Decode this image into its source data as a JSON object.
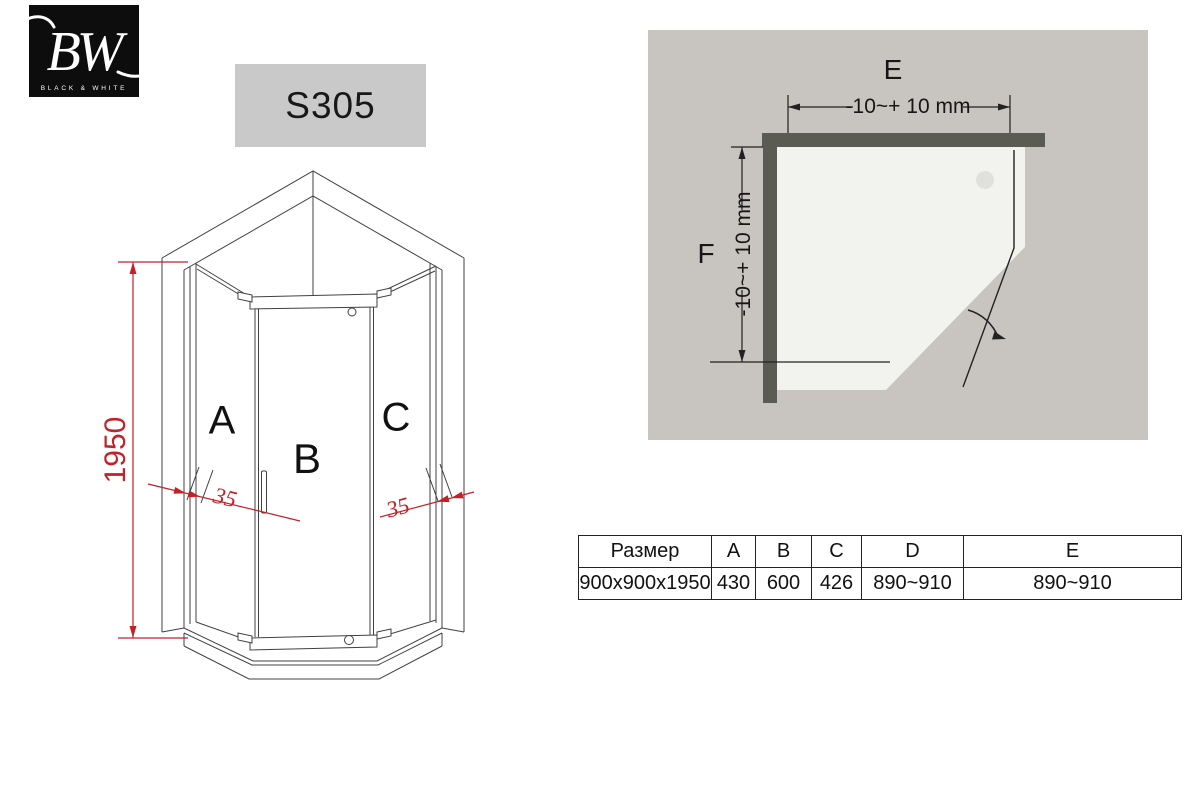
{
  "logo": {
    "monogram": "BW",
    "caption": "BLACK & WHITE"
  },
  "model_badge": "S305",
  "front_view": {
    "height_dim": "1950",
    "left_profile_dim": "35",
    "right_profile_dim": "35",
    "panel_labels": {
      "left": "A",
      "door": "B",
      "right": "C"
    }
  },
  "top_view": {
    "width_label": "E",
    "depth_label": "F",
    "width_adjust": "-10~+ 10 mm",
    "depth_adjust": "-10~+ 10 mm"
  },
  "table": {
    "headers": [
      "Размер",
      "A",
      "B",
      "C",
      "D",
      "E"
    ],
    "rows": [
      [
        "900x900x1950",
        "430",
        "600",
        "426",
        "890~910",
        "890~910"
      ]
    ]
  },
  "colors": {
    "dim_red": "#c32127",
    "wall_gray": "#5a5c54",
    "panel_background": "#c8c5c0",
    "tray_white": "#f2f2ee",
    "badge_gray": "#c9c9c9",
    "line_gray": "#404040"
  }
}
